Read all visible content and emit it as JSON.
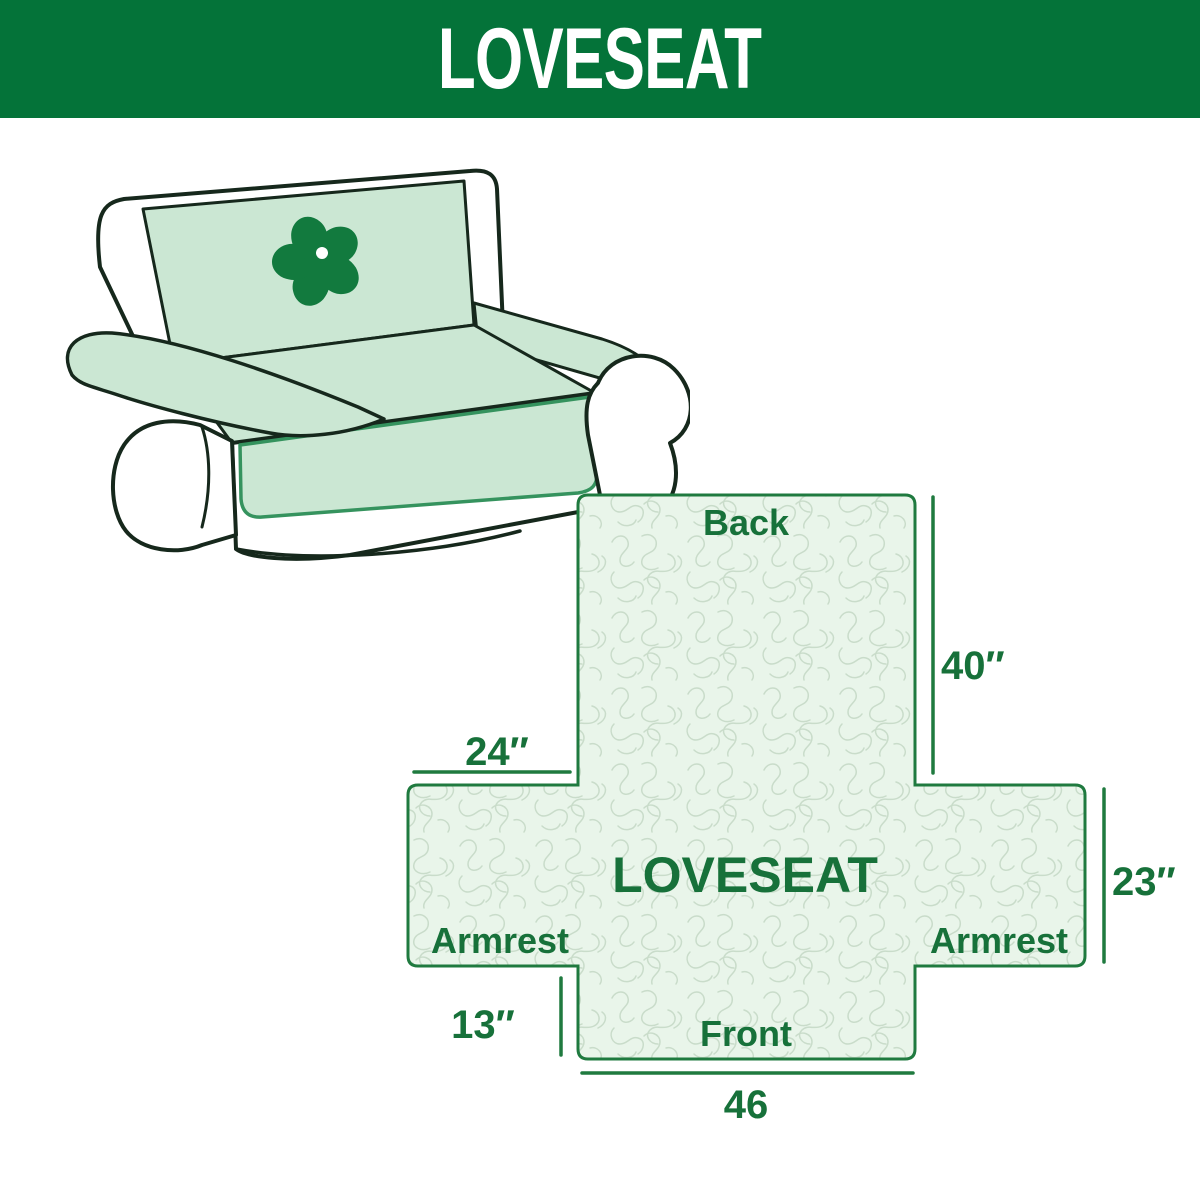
{
  "header": {
    "title": "LOVESEAT"
  },
  "sofa": {
    "description": "line-drawing of a two-seat loveseat with mint slipcover",
    "logo_icon": "pinwheel-icon",
    "cover_color": "#cbe7d3",
    "logo_color": "#127a3e"
  },
  "diagram": {
    "center_label": "LOVESEAT",
    "back_label": "Back",
    "front_label": "Front",
    "armrest_left_label": "Armrest",
    "armrest_right_label": "Armrest",
    "dims": {
      "back_height": "40″",
      "back_side_width": "24″",
      "armrest_height": "23″",
      "front_drop": "13″",
      "front_width": "46"
    }
  },
  "colors": {
    "header_background": "#047339",
    "header_text": "#ffffff",
    "diagram_outline": "#1f7a3f",
    "diagram_fill": "#e9f5ea",
    "diagram_pattern_line": "#c9dcca",
    "label_text": "#17713a",
    "sofa_outline": "#16281c",
    "sofa_cover": "#cbe7d3"
  }
}
